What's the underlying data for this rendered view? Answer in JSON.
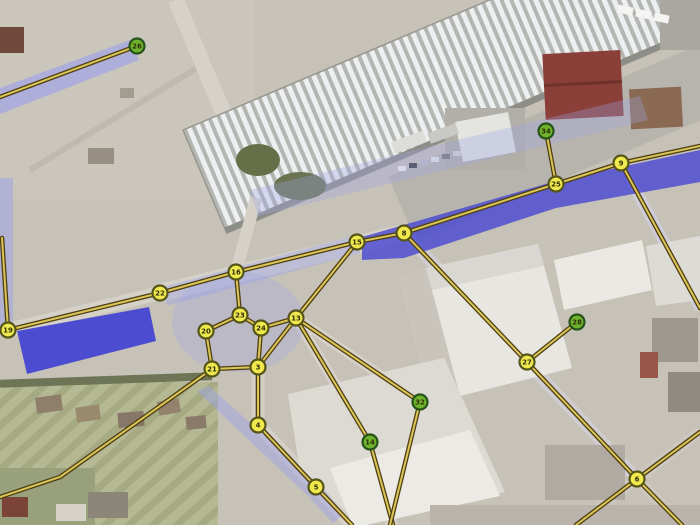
{
  "map": {
    "canvas": {
      "width": 700,
      "height": 525
    },
    "colors": {
      "edge_outline": "#4e3e12",
      "edge_core": "#d9c558",
      "node_yellow_fill": "#efe94e",
      "node_yellow_stroke": "#55551a",
      "node_green_fill": "#6fb32c",
      "node_green_stroke": "#27521a",
      "node_label": "#2e2e08",
      "highlight_strong": "#4646d2",
      "highlight_light": "#9fa4e6"
    },
    "nodes": [
      {
        "id": "26",
        "x": 137,
        "y": 46,
        "type": "green"
      },
      {
        "id": "19",
        "x": 8,
        "y": 330,
        "type": "yellow"
      },
      {
        "id": "22",
        "x": 160,
        "y": 293,
        "type": "yellow"
      },
      {
        "id": "16",
        "x": 236,
        "y": 272,
        "type": "yellow"
      },
      {
        "id": "23",
        "x": 240,
        "y": 315,
        "type": "yellow"
      },
      {
        "id": "20",
        "x": 206,
        "y": 331,
        "type": "yellow"
      },
      {
        "id": "24",
        "x": 261,
        "y": 328,
        "type": "yellow"
      },
      {
        "id": "21",
        "x": 212,
        "y": 369,
        "type": "yellow"
      },
      {
        "id": "3",
        "x": 258,
        "y": 367,
        "type": "yellow"
      },
      {
        "id": "4",
        "x": 258,
        "y": 425,
        "type": "yellow"
      },
      {
        "id": "5",
        "x": 316,
        "y": 487,
        "type": "yellow"
      },
      {
        "id": "13",
        "x": 296,
        "y": 318,
        "type": "yellow"
      },
      {
        "id": "15",
        "x": 357,
        "y": 242,
        "type": "yellow"
      },
      {
        "id": "8",
        "x": 404,
        "y": 233,
        "type": "yellow"
      },
      {
        "id": "25",
        "x": 556,
        "y": 184,
        "type": "yellow"
      },
      {
        "id": "34",
        "x": 546,
        "y": 131,
        "type": "green"
      },
      {
        "id": "9",
        "x": 621,
        "y": 163,
        "type": "yellow"
      },
      {
        "id": "27",
        "x": 527,
        "y": 362,
        "type": "yellow"
      },
      {
        "id": "28",
        "x": 577,
        "y": 322,
        "type": "green"
      },
      {
        "id": "6",
        "x": 637,
        "y": 479,
        "type": "yellow"
      },
      {
        "id": "32",
        "x": 420,
        "y": 402,
        "type": "green"
      },
      {
        "id": "14",
        "x": 370,
        "y": 442,
        "type": "green"
      }
    ],
    "edges": [
      [
        [
          0,
          97
        ],
        [
          137,
          46
        ]
      ],
      [
        [
          2,
          238
        ],
        [
          8,
          330
        ]
      ],
      [
        [
          8,
          330
        ],
        [
          160,
          293
        ]
      ],
      [
        [
          160,
          293
        ],
        [
          236,
          272
        ]
      ],
      [
        [
          236,
          272
        ],
        [
          357,
          242
        ]
      ],
      [
        [
          357,
          242
        ],
        [
          404,
          233
        ]
      ],
      [
        [
          404,
          233
        ],
        [
          556,
          184
        ]
      ],
      [
        [
          556,
          184
        ],
        [
          621,
          163
        ]
      ],
      [
        [
          621,
          163
        ],
        [
          700,
          146
        ]
      ],
      [
        [
          556,
          184
        ],
        [
          546,
          131
        ]
      ],
      [
        [
          621,
          163
        ],
        [
          700,
          308
        ]
      ],
      [
        [
          404,
          233
        ],
        [
          527,
          362
        ]
      ],
      [
        [
          527,
          362
        ],
        [
          577,
          322
        ]
      ],
      [
        [
          527,
          362
        ],
        [
          637,
          479
        ]
      ],
      [
        [
          637,
          479
        ],
        [
          682,
          525
        ]
      ],
      [
        [
          700,
          432
        ],
        [
          637,
          479
        ]
      ],
      [
        [
          637,
          479
        ],
        [
          576,
          525
        ]
      ],
      [
        [
          296,
          318
        ],
        [
          357,
          242
        ]
      ],
      [
        [
          296,
          318
        ],
        [
          420,
          402
        ]
      ],
      [
        [
          296,
          318
        ],
        [
          370,
          442
        ]
      ],
      [
        [
          370,
          442
        ],
        [
          393,
          525
        ]
      ],
      [
        [
          420,
          402
        ],
        [
          390,
          525
        ]
      ],
      [
        [
          316,
          487
        ],
        [
          352,
          525
        ]
      ],
      [
        [
          258,
          425
        ],
        [
          316,
          487
        ]
      ],
      [
        [
          258,
          367
        ],
        [
          258,
          425
        ]
      ],
      [
        [
          296,
          318
        ],
        [
          261,
          328
        ]
      ],
      [
        [
          236,
          272
        ],
        [
          240,
          315
        ]
      ],
      [
        [
          240,
          315
        ],
        [
          206,
          331
        ]
      ],
      [
        [
          240,
          315
        ],
        [
          261,
          328
        ]
      ],
      [
        [
          206,
          331
        ],
        [
          212,
          369
        ]
      ],
      [
        [
          261,
          328
        ],
        [
          258,
          367
        ]
      ],
      [
        [
          212,
          369
        ],
        [
          258,
          367
        ]
      ],
      [
        [
          212,
          369
        ],
        [
          60,
          477
        ],
        [
          0,
          497
        ]
      ],
      [
        [
          296,
          318
        ],
        [
          258,
          367
        ]
      ]
    ],
    "highlights": [
      {
        "shape": "polygon",
        "tone": "light",
        "opacity": 0.32,
        "points": [
          [
            250,
            190
          ],
          [
            640,
            96
          ],
          [
            648,
            120
          ],
          [
            258,
            216
          ]
        ]
      },
      {
        "shape": "polygon",
        "tone": "light",
        "opacity": 0.7,
        "points": [
          [
            0,
            88
          ],
          [
            130,
            40
          ],
          [
            139,
            60
          ],
          [
            0,
            114
          ]
        ]
      },
      {
        "shape": "polygon",
        "tone": "light",
        "opacity": 0.55,
        "points": [
          [
            0,
            178
          ],
          [
            13,
            178
          ],
          [
            13,
            332
          ],
          [
            0,
            332
          ]
        ]
      },
      {
        "shape": "polygon",
        "tone": "light",
        "opacity": 0.45,
        "points": [
          [
            163,
            287
          ],
          [
            357,
            235
          ],
          [
            360,
            253
          ],
          [
            167,
            306
          ]
        ]
      },
      {
        "shape": "ellipse",
        "tone": "light",
        "opacity": 0.3,
        "cx": 238,
        "cy": 322,
        "rx": 66,
        "ry": 50
      },
      {
        "shape": "polygon",
        "tone": "light",
        "opacity": 0.5,
        "points": [
          [
            197,
            391
          ],
          [
            209,
            386
          ],
          [
            324,
            489
          ],
          [
            344,
            514
          ],
          [
            333,
            523
          ],
          [
            308,
            496
          ]
        ]
      },
      {
        "shape": "polygon",
        "tone": "strong",
        "opacity": 0.95,
        "points": [
          [
            17,
            331
          ],
          [
            149,
            307
          ],
          [
            156,
            341
          ],
          [
            27,
            374
          ]
        ]
      },
      {
        "shape": "polygon",
        "tone": "strong",
        "opacity": 0.8,
        "points": [
          [
            362,
            237
          ],
          [
            556,
            181
          ],
          [
            700,
            150
          ],
          [
            700,
            182
          ],
          [
            556,
            208
          ],
          [
            404,
            258
          ],
          [
            362,
            260
          ]
        ]
      }
    ]
  }
}
